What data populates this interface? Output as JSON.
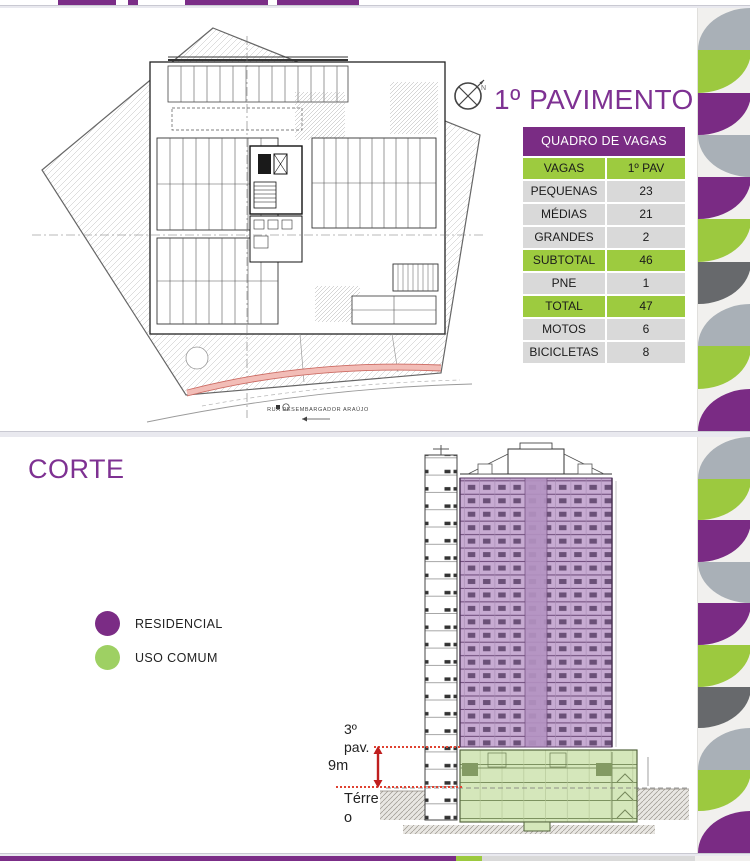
{
  "slide1": {
    "title": "1º PAVIMENTO",
    "compass_label": "N",
    "plan": {
      "street_label": "RUA DESEMBARGADOR ARAÚJO"
    },
    "table": {
      "title": "QUADRO DE VAGAS",
      "rows": [
        {
          "label": "VAGAS",
          "value": "1º PAV",
          "highlight": true
        },
        {
          "label": "PEQUENAS",
          "value": "23"
        },
        {
          "label": "MÉDIAS",
          "value": "21"
        },
        {
          "label": "GRANDES",
          "value": "2"
        },
        {
          "label": "SUBTOTAL",
          "value": "46",
          "highlight": true
        },
        {
          "label": "PNE",
          "value": "1"
        },
        {
          "label": "TOTAL",
          "value": "47",
          "highlight": true
        },
        {
          "label": "MOTOS",
          "value": "6"
        },
        {
          "label": "BICICLETAS",
          "value": "8"
        }
      ]
    }
  },
  "slide2": {
    "title": "CORTE",
    "legend": [
      {
        "label": "RESIDENCIAL",
        "color": "#7b2c85"
      },
      {
        "label": "USO COMUM",
        "color": "#9ed063"
      }
    ],
    "annotations": {
      "floor3": "3º pav.",
      "height": "9m",
      "ground": "Térreo"
    }
  },
  "colors": {
    "accent_purple": "#7e3192",
    "table_header_bg": "#7a2c84",
    "table_green": "#9dcb3f",
    "table_gray": "#d9d9d9",
    "strip_purple": "#7a2b84",
    "strip_green": "#9cc93f",
    "strip_light_gray": "#a9b0b7",
    "strip_dark_gray": "#67696c",
    "section_residential_fill": "#c7abd2",
    "section_common_fill": "#d5e7bb",
    "annotation_red": "#df4231"
  }
}
